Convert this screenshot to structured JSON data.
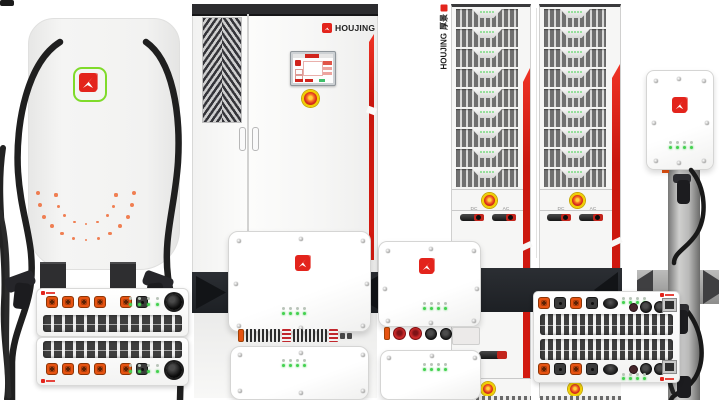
{
  "page": {
    "background": "#ffffff",
    "width": 719,
    "height": 400
  },
  "brand": {
    "name": "HOUJING",
    "name_cn": "厚景",
    "icons": {
      "logo": "bird-arrow-icon",
      "fan": "cooling-fan",
      "estop": "emergency-stop"
    },
    "colors": {
      "red": "#e3241c",
      "accent_red": "#d81e13",
      "green_outline": "#7fdb2a",
      "led_green": "#43d14f",
      "led_off": "#b9c4b9",
      "connector_orange": "#e65311",
      "estop_yellow": "#f2cf00",
      "dot_orange": "#ee6a36",
      "cable_black": "#1f1f1f"
    }
  },
  "cabinet": {
    "logo_text": "HOUJING"
  },
  "rack": {
    "vertical_en": "HOUJING",
    "vertical_cn": "厚景",
    "rack_count": 2,
    "modules_per_rack": 9,
    "switch_labels": [
      "DC",
      "AC"
    ]
  },
  "station": {
    "outer_dot_count": 13,
    "inner_dot_count": 9
  },
  "left_modules": {
    "count": 2,
    "connectors": [
      "orange",
      "orange",
      "orange",
      "orange",
      "gap",
      "orange",
      "dark"
    ],
    "led_pairs": {
      "led_group_count": 4,
      "leds_per_group": 2
    }
  },
  "wallbox_front": {
    "leds": {
      "led_rows": 2,
      "leds_per_row": 4
    },
    "terminals": [
      "orange-cap",
      "stripes",
      "stripes",
      "stripes",
      "red-bars",
      "stripes",
      "stripes",
      "stripes",
      "red-bars",
      "small",
      "small"
    ]
  },
  "wallbox_side": {
    "leds": {
      "led_rows": 2,
      "leds_per_row": 4
    },
    "connectors": [
      "orange-cap",
      "red-circle",
      "red-circle",
      "dark-circle",
      "dark-circle",
      "dark-circle"
    ]
  },
  "wide_module": {
    "row_connectors": [
      "orange",
      "dark",
      "orange",
      "dark"
    ],
    "round_connectors": [
      "maroon",
      "dark-circle",
      "dark-circle"
    ],
    "leds": {
      "led_rows": 2,
      "leds_per_row": 4
    }
  },
  "pedestal": {
    "leds": {
      "led_rows": 2,
      "leds_per_row": 4
    }
  }
}
